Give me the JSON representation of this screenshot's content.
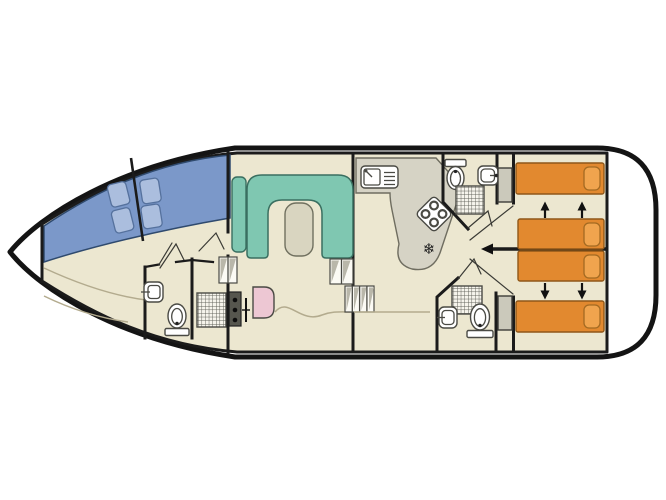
{
  "plan": {
    "type": "boat-floor-plan",
    "orientation": "bow-left-stern-right",
    "rooms": [
      {
        "name": "bow-cabin",
        "fixtures": [
          "double-bed-blue",
          "pillows-x4"
        ]
      },
      {
        "name": "fore-bathroom",
        "fixtures": [
          "washbasin",
          "toilet",
          "shower"
        ]
      },
      {
        "name": "saloon",
        "fixtures": [
          "u-shaped-sofa",
          "table",
          "helm-console",
          "helm-seat",
          "steps"
        ]
      },
      {
        "name": "galley",
        "fixtures": [
          "sink-with-drainer",
          "hob-4-burners",
          "fridge-snowflake",
          "steps"
        ]
      },
      {
        "name": "mid-bathroom",
        "fixtures": [
          "toilet",
          "washbasin",
          "shower"
        ]
      },
      {
        "name": "aft-bathroom",
        "fixtures": [
          "washbasin",
          "shower",
          "toilet"
        ]
      },
      {
        "name": "aft-cabin-top",
        "fixtures": [
          "single-bed",
          "sliding-bed",
          "wardrobe",
          "arrows-up"
        ]
      },
      {
        "name": "aft-cabin-bottom",
        "fixtures": [
          "sliding-bed",
          "single-bed",
          "wardrobe",
          "arrows-down"
        ]
      },
      {
        "name": "stern-deck",
        "fixtures": []
      }
    ],
    "counts": {
      "berths_fixed": 4,
      "double_berth_bow": 1,
      "toilets": 3,
      "showers": 3,
      "washbasins": 3,
      "hob_burners": 4
    }
  },
  "colors": {
    "hull_outline": "#141414",
    "wall": "#1b1b1b",
    "interior_floor": "#ece7d0",
    "bed_blue": "#7b98c9",
    "pillow_blue": "#abbede",
    "sofa_teal": "#7fc7b1",
    "table_beige": "#d9d5c0",
    "counter_grey": "#d6d3c5",
    "bed_orange": "#e2892f",
    "pillow_orange": "#f0a44e",
    "seat_pink": "#edc7d3",
    "wardrobe_grey": "#cbc9bb",
    "console_dark": "#56564e",
    "floor_line": "#b3ab8e",
    "arrow_black": "#111111"
  },
  "icons": {
    "fridge": "snowflake-icon",
    "fridge_glyph": "❄"
  }
}
